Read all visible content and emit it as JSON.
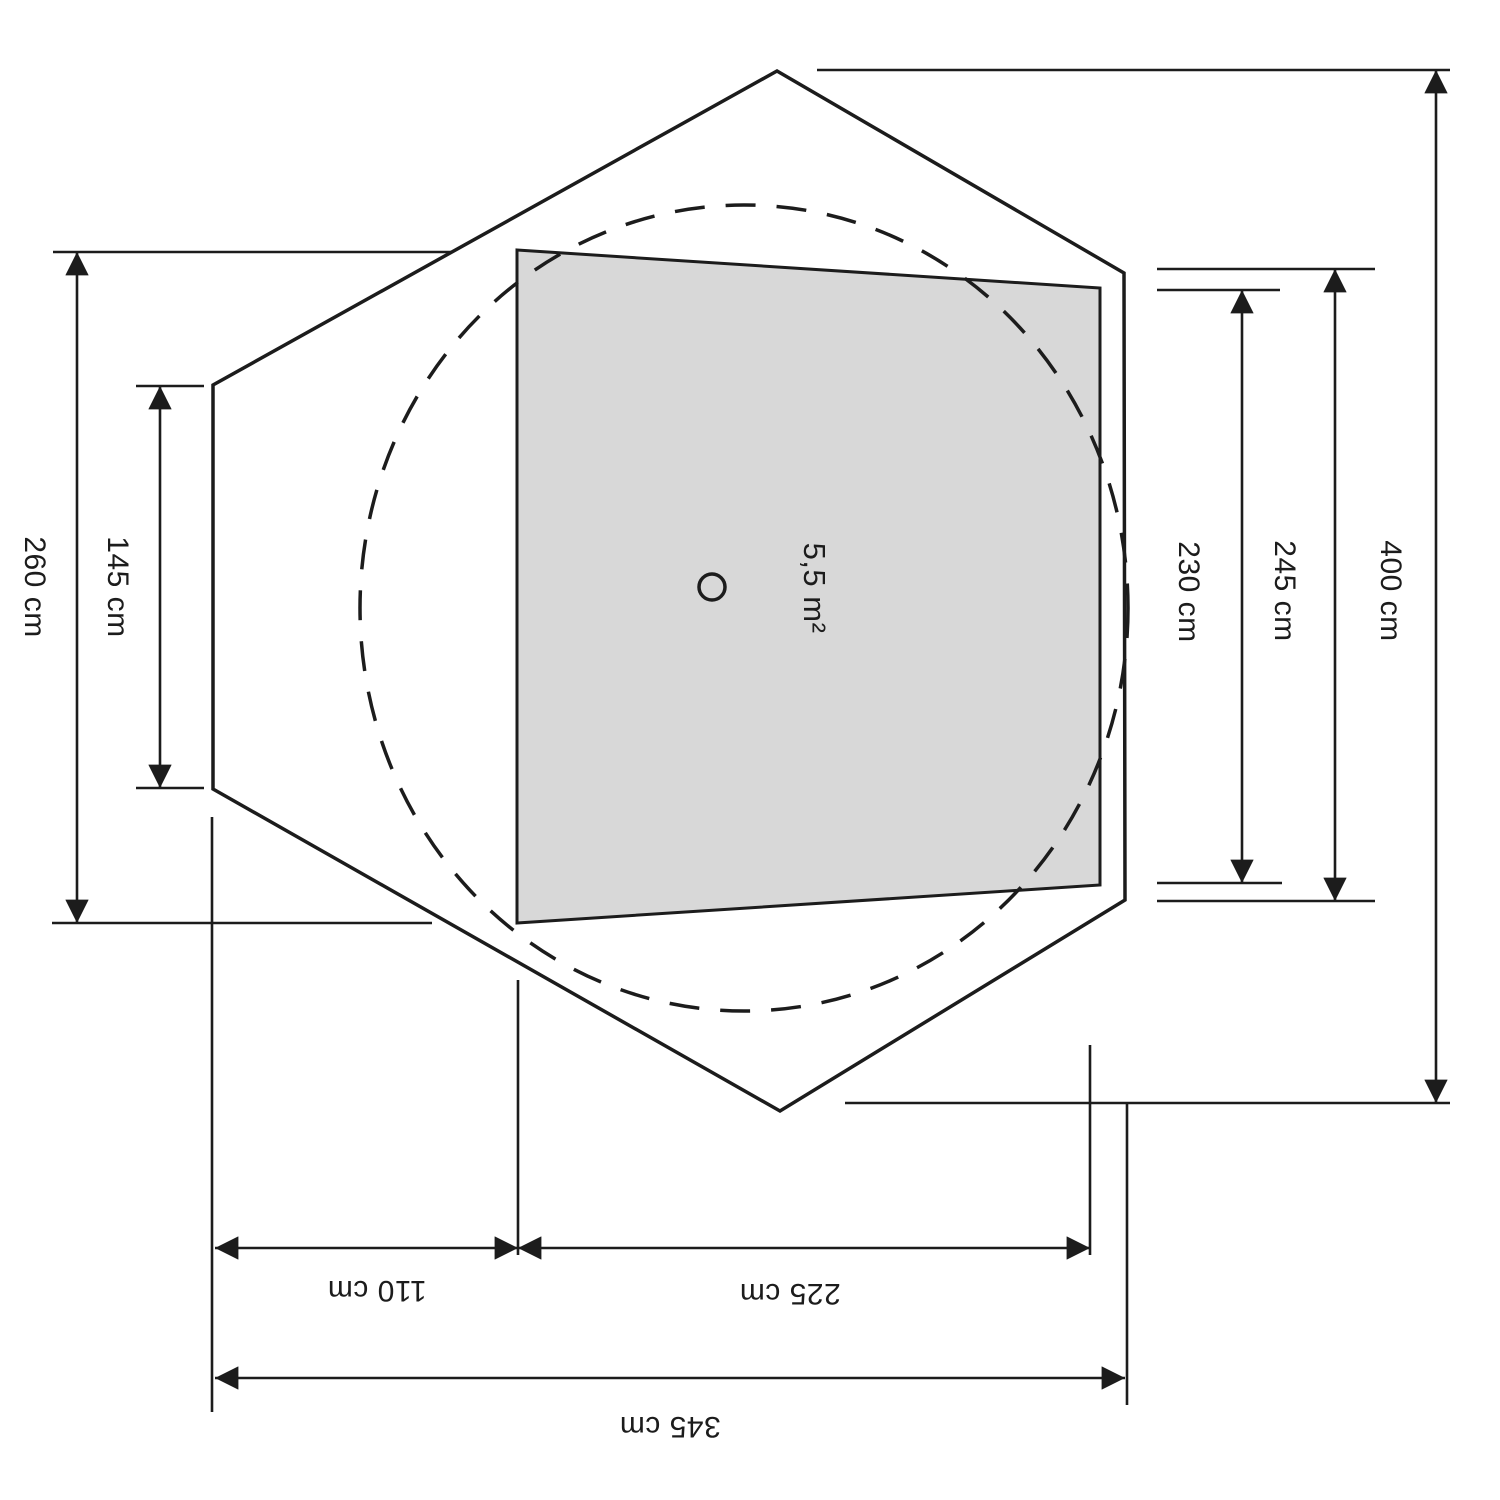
{
  "diagram": {
    "title": "tent-floorplan-dimension-drawing",
    "area_label": "5,5 m²",
    "dimensions": {
      "left_outer": "260 cm",
      "left_inner": "145 cm",
      "right_inner": "230 cm",
      "right_mid": "245 cm",
      "right_outer": "400 cm",
      "bottom_left": "110 cm",
      "bottom_mid": "225 cm",
      "bottom_total": "345 cm"
    },
    "colors": {
      "line": "#1c1c1c",
      "floor_fill": "#d8d8d8",
      "background": "#ffffff"
    }
  }
}
